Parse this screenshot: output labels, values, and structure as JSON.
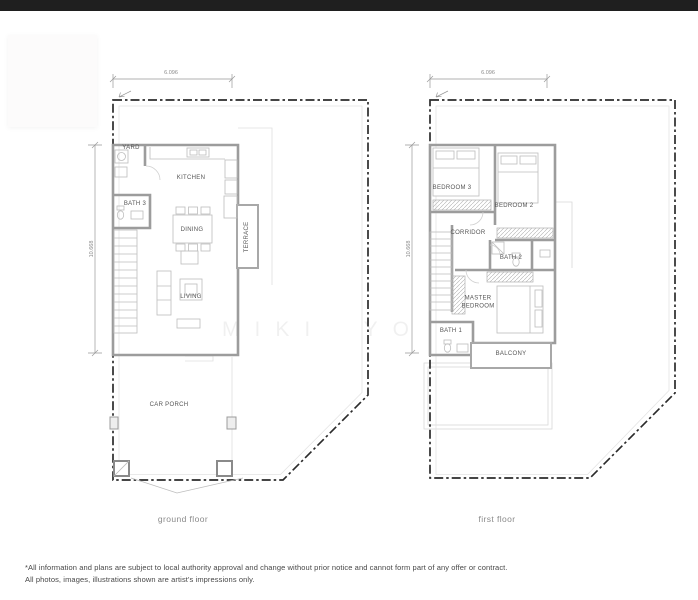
{
  "page": {
    "watermark": "MIKI YO",
    "disclaimer_line1": "*All information and plans are subject to local authority approval and change without prior notice and cannot form part of any offer or contract.",
    "disclaimer_line2": "All photos, images, illustrations shown are artist's impressions only."
  },
  "ground_floor": {
    "caption": "ground floor",
    "dim_width": "6.096",
    "dim_depth": "10.668",
    "rooms": {
      "yard": "YARD",
      "kitchen": "KITCHEN",
      "bath3": "BATH 3",
      "dining": "DINING",
      "terrace": "TERRACE",
      "living": "LIVING",
      "car_porch": "CAR PORCH"
    }
  },
  "first_floor": {
    "caption": "first floor",
    "dim_width": "6.096",
    "dim_depth": "10.668",
    "rooms": {
      "bedroom3": "BEDROOM 3",
      "bedroom2": "BEDROOM 2",
      "corridor": "CORRIDOR",
      "bath2": "BATH 2",
      "master_bedroom": "MASTER BEDROOM",
      "bath1": "BATH 1",
      "balcony": "BALCONY"
    }
  },
  "colors": {
    "top_bar": "#1f1f1f",
    "boundary_line": "#2b2b2b",
    "wall": "#9c9c9c",
    "fixture_line": "#bdbdbd",
    "room_label": "#555555",
    "dimension_text": "#8a8a8a",
    "caption_text": "#8a8a8a",
    "disclaimer_text": "#474747",
    "background": "#ffffff"
  }
}
